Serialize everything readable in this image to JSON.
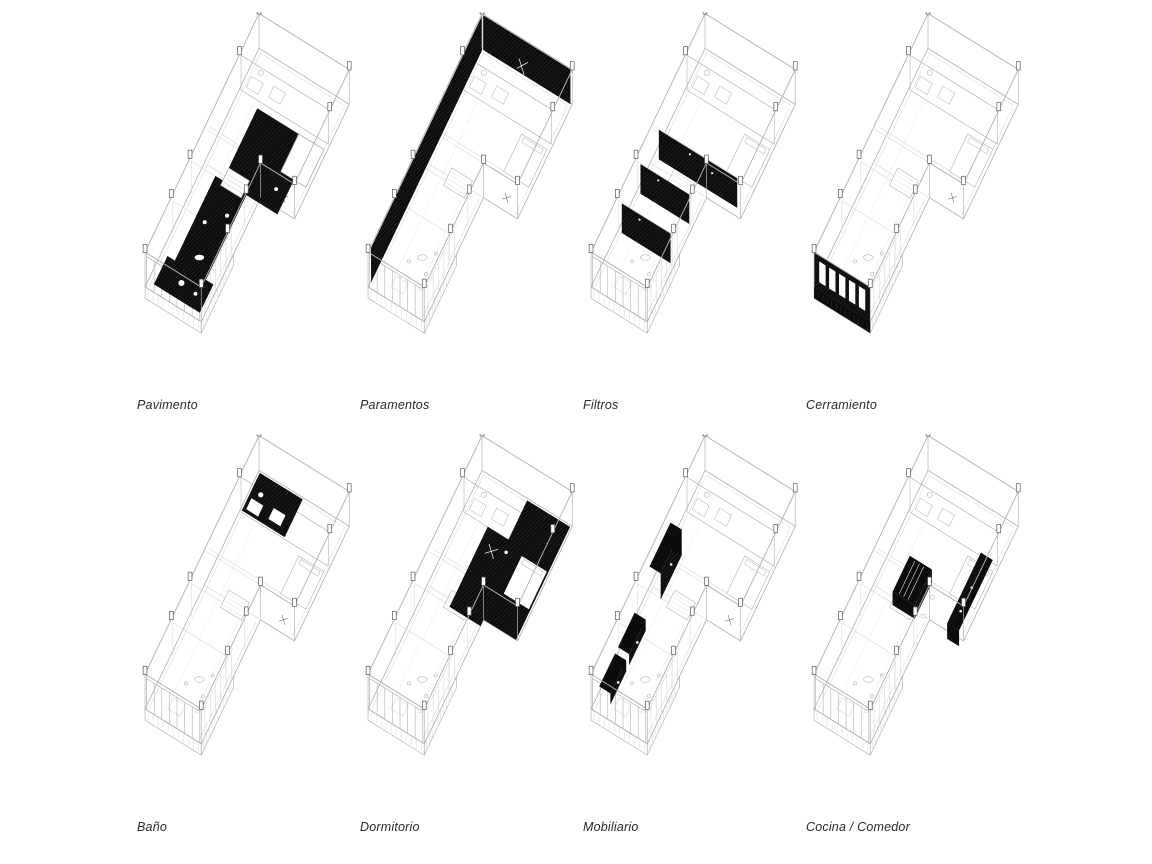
{
  "page": {
    "background": "#ffffff"
  },
  "figures": [
    {
      "id": "pavimento",
      "label": "Pavimento",
      "highlight": "floor"
    },
    {
      "id": "paramentos",
      "label": "Paramentos",
      "highlight": "walls"
    },
    {
      "id": "filtros",
      "label": "Filtros",
      "highlight": "curtain-partitions"
    },
    {
      "id": "cerramiento",
      "label": "Cerramiento",
      "highlight": "facade"
    },
    {
      "id": "bano",
      "label": "Baño",
      "highlight": "bathroom"
    },
    {
      "id": "dormitorio",
      "label": "Dormitorio",
      "highlight": "bedroom"
    },
    {
      "id": "mobiliario",
      "label": "Mobiliario",
      "highlight": "furniture"
    },
    {
      "id": "cocina-comedor",
      "label": "Cocina / Comedor",
      "highlight": "kitchen-dining"
    }
  ],
  "colors": {
    "background": "#ffffff",
    "line": "#b3b3b3",
    "line_light": "#d9d9d9",
    "line_dark": "#5a5a5a",
    "highlight": "#0c0c0c",
    "label": "#2a2a2a"
  }
}
